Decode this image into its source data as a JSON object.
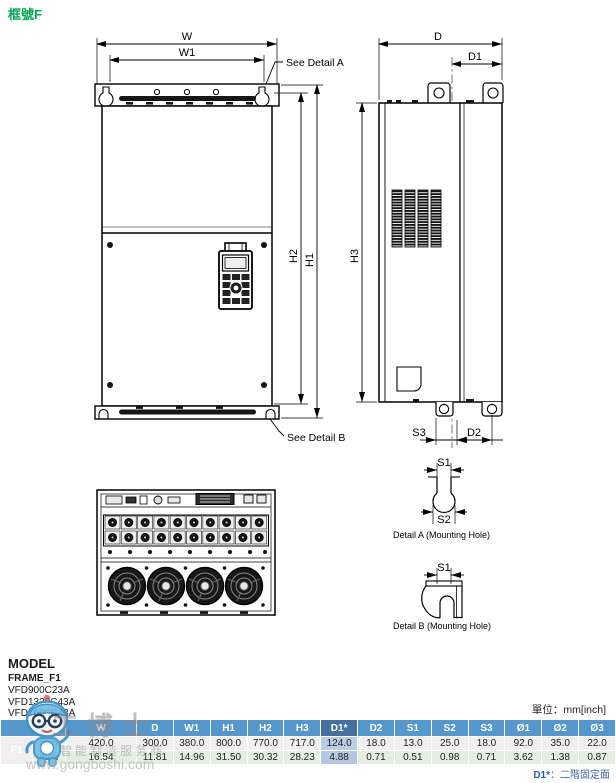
{
  "page": {
    "title": "框號F",
    "unit_note": "單位：mm[inch]",
    "footnote_label": "D1*",
    "footnote_text": "：二階固定面"
  },
  "drawing": {
    "labels": {
      "w": "W",
      "w1": "W1",
      "h1": "H1",
      "h2": "H2",
      "h3": "H3",
      "d": "D",
      "d1": "D1",
      "d2": "D2",
      "s1": "S1",
      "s2": "S2",
      "s3": "S3",
      "see_detail_a": "See Detail A",
      "see_detail_b": "See Detail B",
      "detail_a": "Detail A (Mounting Hole)",
      "detail_b": "Detail B (Mounting Hole)"
    }
  },
  "model_block": {
    "heading": "MODEL",
    "frame": "FRAME_F1",
    "models": [
      "VFD900C23A",
      "VFD1320C43A",
      "VFD1600C43A"
    ]
  },
  "table": {
    "frame_label": "F1",
    "columns": [
      "W",
      "D",
      "W1",
      "H1",
      "H2",
      "H3",
      "D1*",
      "D2",
      "S1",
      "S2",
      "S3",
      "Ø1",
      "Ø2",
      "Ø3"
    ],
    "highlight_column": "D1*",
    "rows": [
      {
        "unit": "mm",
        "values": [
          "420.0",
          "300.0",
          "380.0",
          "800.0",
          "770.0",
          "717.0",
          "124.0",
          "18.0",
          "13.0",
          "25.0",
          "18.0",
          "92.0",
          "35.0",
          "22.0"
        ]
      },
      {
        "unit": "inch",
        "values": [
          "16.54",
          "11.81",
          "14.96",
          "31.50",
          "30.32",
          "28.23",
          "4.88",
          "0.71",
          "0.51",
          "0.98",
          "0.71",
          "3.62",
          "1.38",
          "0.87"
        ]
      }
    ]
  },
  "watermark": {
    "brand": "工博士",
    "tagline": "智能制造服务商",
    "url": "www.gongboshi.com"
  },
  "colors": {
    "title_green": "#00a651",
    "header_blue": "#5596cb",
    "highlight_header": "#46719d",
    "highlight_cell": "#b9cde3",
    "row_mm": "#f1eef0",
    "row_inch": "#e4efe2",
    "frame_cell": "#3c79a9"
  }
}
